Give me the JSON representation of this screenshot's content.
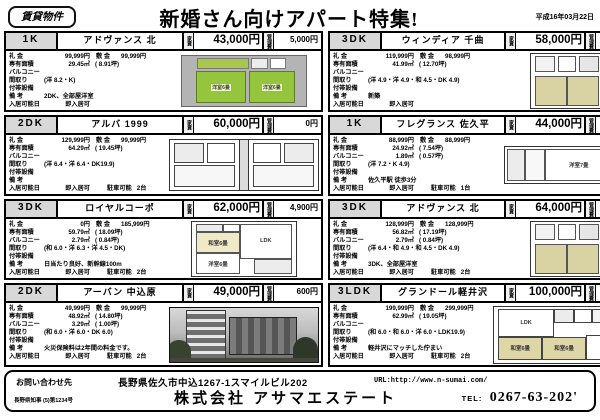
{
  "header": {
    "badge": "賃貸物件",
    "title": "新婚さん向けアパート特集!",
    "date": "平成16年03月22日"
  },
  "labels": {
    "rent": "家賃",
    "fee": "管理費",
    "reikin": "礼 金",
    "shikikin": "敷 金",
    "menseki": "専有面積",
    "balcony": "バルコニー",
    "madori": "間取り",
    "futai": "付帯設備",
    "biko": "備 考",
    "nyukyo": "入居可能日"
  },
  "listings": [
    {
      "type": "1K",
      "name": "アドヴァンス 北",
      "rent": "43,000円",
      "fee": "5,000円",
      "reikin": "99,999円",
      "shikikin": "99,999円",
      "menseki": "29.45㎡",
      "tsubo": "(  8.91坪)",
      "balcony": "",
      "balcony_tsubo": "",
      "madori": "(洋 8.2・K)",
      "futai": "",
      "biko": "2DK、全部屋洋室",
      "nyukyo": "即入居可",
      "parking_label": "",
      "parking": "",
      "plan_rooms": [
        "洋室6畳",
        "洋室6畳"
      ]
    },
    {
      "type": "3DK",
      "name": "ウィンディア 千曲",
      "rent": "58,000円",
      "fee": "0円",
      "reikin": "119,999円",
      "shikikin": "98,999円",
      "menseki": "41.99㎡",
      "tsubo": "( 12.70坪)",
      "balcony": "",
      "balcony_tsubo": "",
      "madori": "(洋 4.9・洋 4.9・和 4.5・DK 4.9)",
      "futai": "",
      "biko": "新築",
      "nyukyo": "即入居可",
      "parking_label": "",
      "parking": "",
      "plan_rooms": []
    },
    {
      "type": "2DK",
      "name": "アルバ 1999",
      "rent": "60,000円",
      "fee": "0円",
      "reikin": "129,999円",
      "shikikin": "99,999円",
      "menseki": "64.29㎡",
      "tsubo": "( 19.45坪)",
      "balcony": "",
      "balcony_tsubo": "",
      "madori": "(洋 6.4・洋 6.4・DK19.9)",
      "futai": "",
      "biko": "",
      "nyukyo": "即入居可",
      "parking_label": "駐車可能",
      "parking": "2台",
      "plan_rooms": []
    },
    {
      "type": "1K",
      "name": "フレグランス 佐久平",
      "rent": "44,000円",
      "fee": "5,200円",
      "reikin": "88,999円",
      "shikikin": "88,999円",
      "menseki": "24.92㎡",
      "tsubo": "(  7.54坪)",
      "balcony": "1.89㎡",
      "balcony_tsubo": "(  0.57坪)",
      "madori": "(洋 7.2・K 4.9)",
      "futai": "",
      "biko": "佐久平駅 徒歩3分",
      "nyukyo": "即入居可",
      "parking_label": "駐車可能",
      "parking": "1台",
      "plan_rooms": [
        "洋室7畳"
      ]
    },
    {
      "type": "3DK",
      "name": "ロイヤルコーポ",
      "rent": "62,000円",
      "fee": "4,900円",
      "reikin": "0円",
      "shikikin": "185,999円",
      "menseki": "59.79㎡",
      "tsubo": "( 18.09坪)",
      "balcony": "2.79㎡",
      "balcony_tsubo": "(  0.84坪)",
      "madori": "(和 6.0・洋 6.3・洋 4.5・DK)",
      "futai": "",
      "biko": "日当たり良好、新幹線100m",
      "nyukyo": "即入居可",
      "parking_label": "駐車可能",
      "parking": "2台",
      "plan_rooms": [
        "LDK",
        "和室6畳",
        "洋室6畳"
      ]
    },
    {
      "type": "3DK",
      "name": "アドヴァンス 北",
      "rent": "64,000円",
      "fee": "5,000円",
      "reikin": "128,999円",
      "shikikin": "128,999円",
      "menseki": "56.82㎡",
      "tsubo": "( 17.19坪)",
      "balcony": "2.79㎡",
      "balcony_tsubo": "(  0.84坪)",
      "madori": "(洋 6.4・和 4.9・和 4.5・DK 4.9)",
      "futai": "",
      "biko": "3DK、全部屋洋室",
      "nyukyo": "即入居可",
      "parking_label": "駐車可能",
      "parking": "2台",
      "plan_rooms": []
    },
    {
      "type": "2DK",
      "name": "アーバン 中込原",
      "rent": "49,000円",
      "fee": "600円",
      "reikin": "49,999円",
      "shikikin": "99,999円",
      "menseki": "48.92㎡",
      "tsubo": "( 14.80坪)",
      "balcony": "3.29㎡",
      "balcony_tsubo": "(  1.00坪)",
      "madori": "(和 6.0・洋 6.0・DK 6.0)",
      "futai": "",
      "biko": "火災保険料は2年間の料金です。",
      "nyukyo": "即入居可",
      "parking_label": "駐車可能",
      "parking": "2台",
      "plan_rooms": []
    },
    {
      "type": "3LDK",
      "name": "グランドール軽井沢",
      "rent": "100,000円",
      "fee": "12,000円",
      "reikin": "199,999円",
      "shikikin": "299,999円",
      "menseki": "62.99㎡",
      "tsubo": "( 19.05坪)",
      "balcony": "",
      "balcony_tsubo": "",
      "madori": "(和 6.0・和 6.0・洋 6.0・LDK19.9)",
      "futai": "",
      "biko": "軽井沢にマッチした佇まい",
      "nyukyo": "即入居可",
      "parking_label": "駐車可能",
      "parking": "2台",
      "plan_rooms": [
        "LDK",
        "和室6畳",
        "和室6畳",
        "洋室6畳"
      ]
    }
  ],
  "footer": {
    "inquiry": "お問い合わせ先",
    "address": "長野県佐久市中込1267-1スマイルビル202",
    "url": "URL:http://www.n-sumai.com/",
    "license": "長野県知事 (5)第1234号",
    "company": "株式会社 アサマエステート",
    "tel_label": "TEL:",
    "tel": "0267-63-202'"
  }
}
